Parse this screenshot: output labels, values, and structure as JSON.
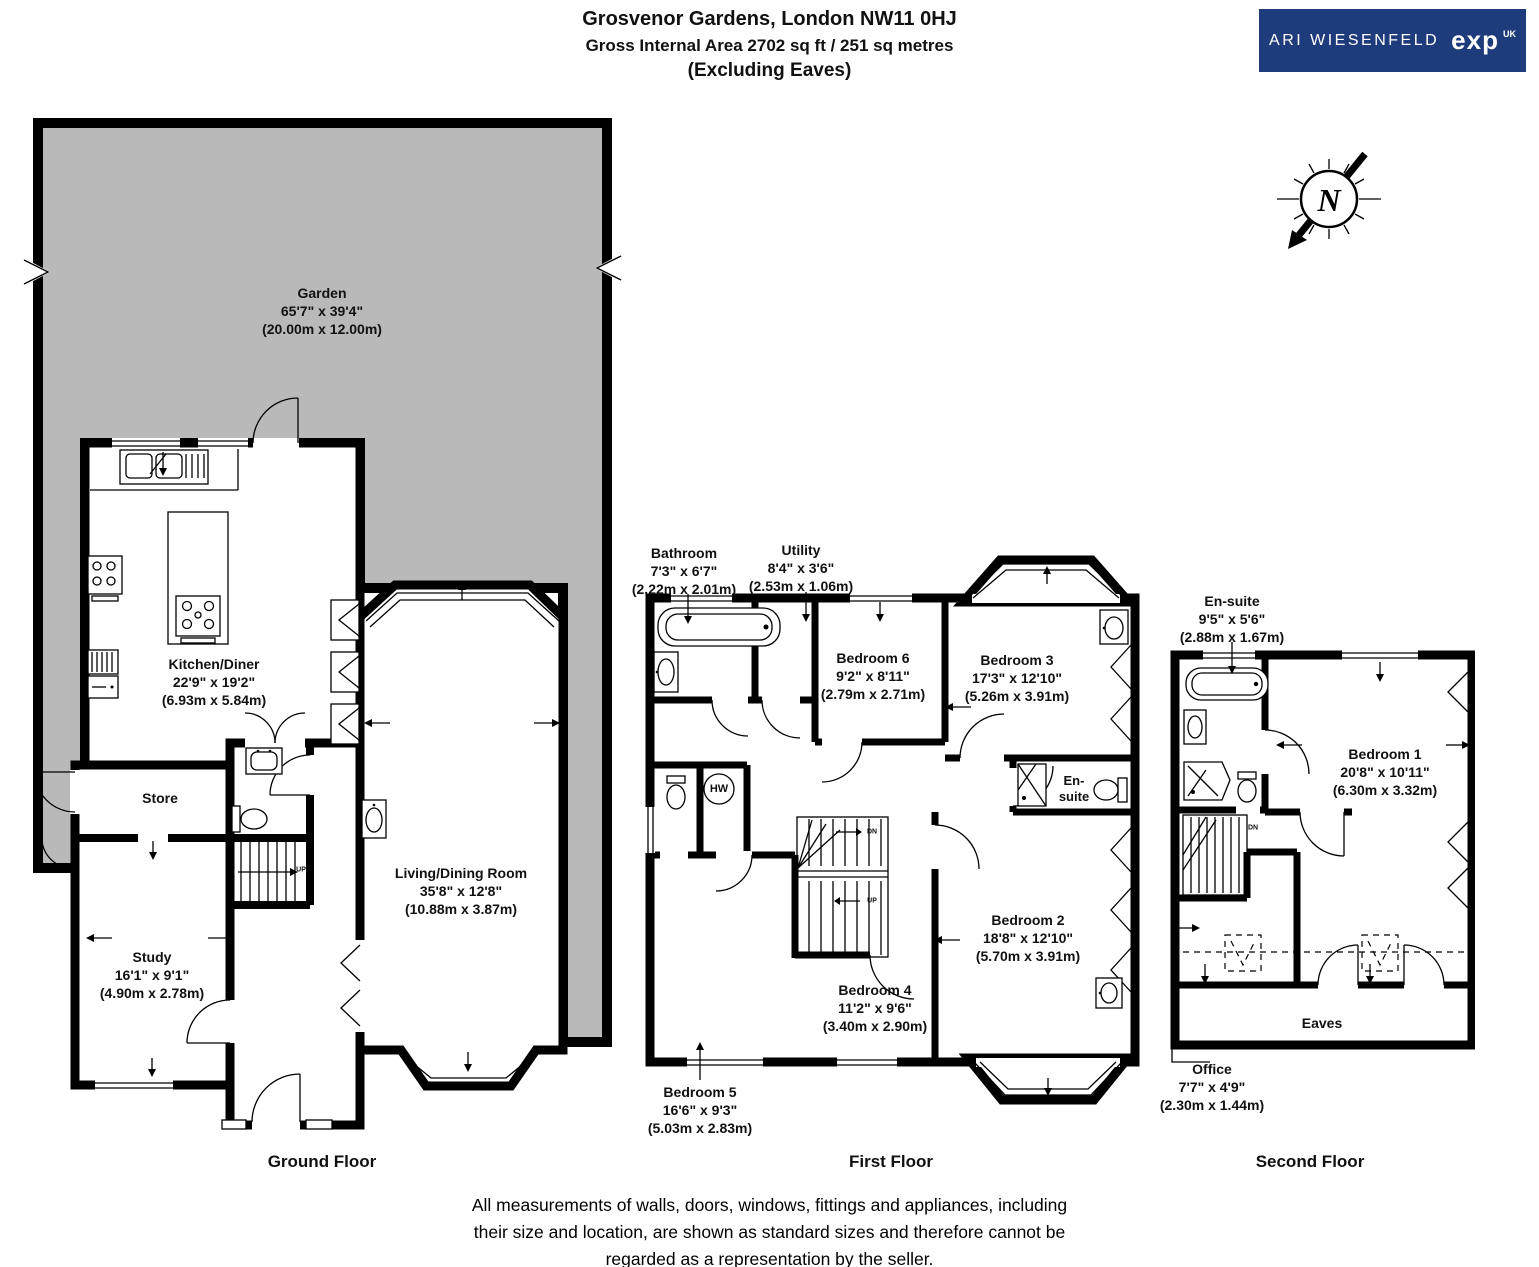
{
  "header": {
    "title": "Grosvenor Gardens, London NW11 0HJ",
    "subtitle": "Gross Internal Area 2702 sq ft / 251 sq metres",
    "note": "(Excluding Eaves)"
  },
  "branding": {
    "agent": "ARI WIESENFELD",
    "brand": "exp",
    "region": "UK",
    "bg_color": "#1e3c7b"
  },
  "compass": {
    "north": "N"
  },
  "stairs": {
    "up": "UP",
    "down": "DN",
    "hot_water": "HW"
  },
  "floors": [
    {
      "name": "Ground Floor",
      "rooms": [
        {
          "name": "Garden",
          "imperial": "65'7\" x 39'4\"",
          "metric": "(20.00m x 12.00m)"
        },
        {
          "name": "Kitchen/Diner",
          "imperial": "22'9\" x 19'2\"",
          "metric": "(6.93m x 5.84m)"
        },
        {
          "name": "Store",
          "imperial": "",
          "metric": ""
        },
        {
          "name": "Study",
          "imperial": "16'1\" x 9'1\"",
          "metric": "(4.90m x 2.78m)"
        },
        {
          "name": "Living/Dining Room",
          "imperial": "35'8\" x 12'8\"",
          "metric": "(10.88m x 3.87m)"
        }
      ]
    },
    {
      "name": "First Floor",
      "rooms": [
        {
          "name": "Bathroom",
          "imperial": "7'3\" x 6'7\"",
          "metric": "(2.22m x 2.01m)"
        },
        {
          "name": "Utility",
          "imperial": "8'4\" x 3'6\"",
          "metric": "(2.53m x 1.06m)"
        },
        {
          "name": "Bedroom 6",
          "imperial": "9'2\" x 8'11\"",
          "metric": "(2.79m x 2.71m)"
        },
        {
          "name": "Bedroom 3",
          "imperial": "17'3\" x 12'10\"",
          "metric": "(5.26m x 3.91m)"
        },
        {
          "name": "En-suite",
          "display": [
            "En-",
            "suite"
          ],
          "imperial": "",
          "metric": ""
        },
        {
          "name": "Bedroom 2",
          "imperial": "18'8\" x 12'10\"",
          "metric": "(5.70m x 3.91m)"
        },
        {
          "name": "Bedroom 4",
          "imperial": "11'2\" x 9'6\"",
          "metric": "(3.40m x 2.90m)"
        },
        {
          "name": "Bedroom 5",
          "imperial": "16'6\" x 9'3\"",
          "metric": "(5.03m x 2.83m)"
        }
      ]
    },
    {
      "name": "Second Floor",
      "rooms": [
        {
          "name": "En-suite",
          "imperial": "9'5\" x 5'6\"",
          "metric": "(2.88m x 1.67m)"
        },
        {
          "name": "Bedroom 1",
          "imperial": "20'8\" x 10'11\"",
          "metric": "(6.30m x 3.32m)"
        },
        {
          "name": "Eaves",
          "imperial": "",
          "metric": ""
        },
        {
          "name": "Office",
          "imperial": "7'7\" x 4'9\"",
          "metric": "(2.30m x 1.44m)"
        }
      ]
    }
  ],
  "disclaimer": {
    "line1": "All measurements of walls, doors, windows, fittings and appliances, including",
    "line2": "their size and location, are shown as standard sizes and therefore cannot be",
    "line3": "regarded as a representation by the seller."
  }
}
